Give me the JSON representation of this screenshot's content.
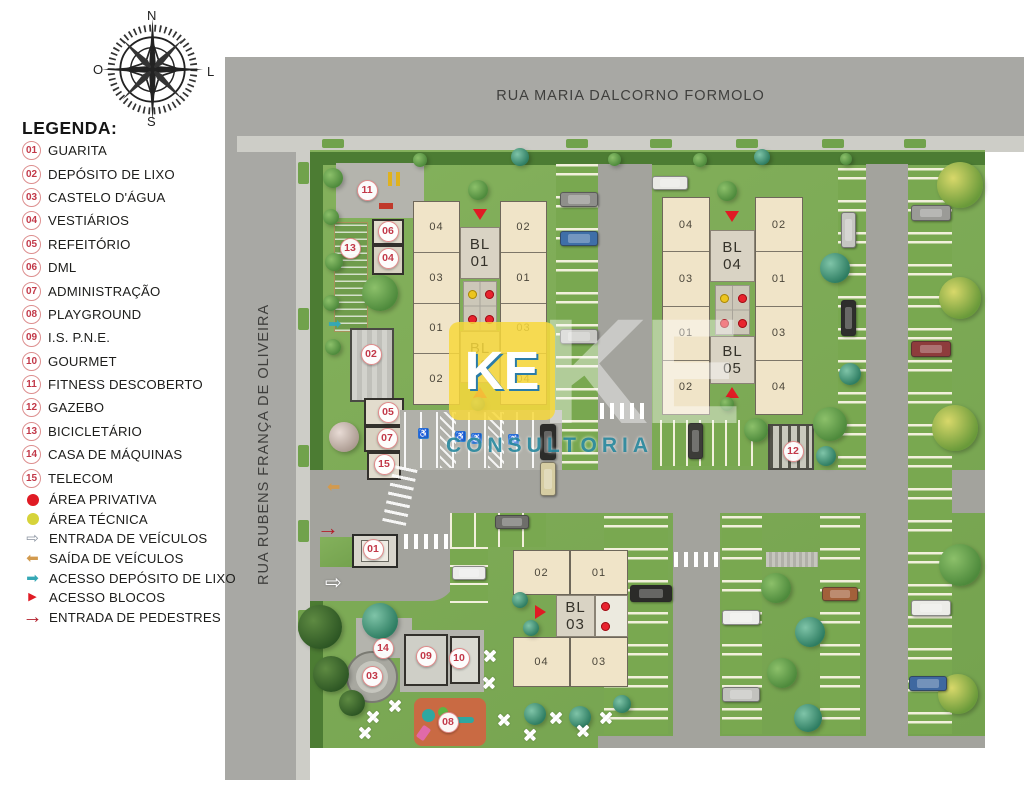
{
  "page": {
    "background": "#ffffff"
  },
  "compass": {
    "north": "N",
    "south": "S",
    "east": "L",
    "west": "O"
  },
  "streets": {
    "top": "RUA MARIA DALCORNO FORMOLO",
    "left": "RUA RUBENS FRANÇA DE OLIVEIRA"
  },
  "legend": {
    "title": "LEGENDA:",
    "numbered_items": [
      {
        "num": "01",
        "label": "GUARITA"
      },
      {
        "num": "02",
        "label": "DEPÓSITO DE LIXO"
      },
      {
        "num": "03",
        "label": "CASTELO D'ÁGUA"
      },
      {
        "num": "04",
        "label": "VESTIÁRIOS"
      },
      {
        "num": "05",
        "label": "REFEITÓRIO"
      },
      {
        "num": "06",
        "label": "DML"
      },
      {
        "num": "07",
        "label": "ADMINISTRAÇÃO"
      },
      {
        "num": "08",
        "label": "PLAYGROUND"
      },
      {
        "num": "09",
        "label": "I.S. P.N.E."
      },
      {
        "num": "10",
        "label": "GOURMET"
      },
      {
        "num": "11",
        "label": "FITNESS DESCOBERTO"
      },
      {
        "num": "12",
        "label": "GAZEBO"
      },
      {
        "num": "13",
        "label": "BICICLETÁRIO"
      },
      {
        "num": "14",
        "label": "CASA DE MÁQUINAS"
      },
      {
        "num": "15",
        "label": "TELECOM"
      }
    ],
    "symbol_items": [
      {
        "icon": "area-privativa-dot",
        "label": "ÁREA PRIVATIVA",
        "color": "#e01b24"
      },
      {
        "icon": "area-tecnica-dot",
        "label": "ÁREA TÉCNICA",
        "color": "#d6d33a"
      },
      {
        "icon": "entrada-veiculos-arrow",
        "label": "ENTRADA DE VEÍCULOS",
        "color": "#8a93a0"
      },
      {
        "icon": "saida-veiculos-arrow",
        "label": "SAÍDA DE VEÍCULOS",
        "color": "#d29a4e"
      },
      {
        "icon": "acesso-deposito-arrow",
        "label": "ACESSO DEPÓSITO DE LIXO",
        "color": "#35a8b5"
      },
      {
        "icon": "acesso-blocos-triangle",
        "label": "ACESSO BLOCOS",
        "color": "#e01b24"
      },
      {
        "icon": "entrada-pedestres-arrow",
        "label": "ENTRADA DE PEDESTRES",
        "color": "#b3202c"
      }
    ]
  },
  "buildings": {
    "bl01_02": {
      "top_label": [
        "BL",
        "01"
      ],
      "bottom_label": [
        "BL",
        "02"
      ],
      "left_units": [
        "04",
        "03",
        "01",
        "02"
      ],
      "right_units": [
        "02",
        "01",
        "03",
        "04"
      ]
    },
    "bl04_05": {
      "top_label": [
        "BL",
        "04"
      ],
      "bottom_label": [
        "BL",
        "05"
      ],
      "left_units": [
        "04",
        "03",
        "01",
        "02"
      ],
      "right_units": [
        "02",
        "01",
        "03",
        "04"
      ]
    },
    "bl03": {
      "label": [
        "BL",
        "03"
      ],
      "top_units": [
        "02",
        "01"
      ],
      "bottom_units": [
        "04",
        "03"
      ]
    }
  },
  "map_markers": [
    "01",
    "02",
    "03",
    "04",
    "05",
    "06",
    "07",
    "08",
    "09",
    "10",
    "11",
    "12",
    "13",
    "14",
    "15"
  ],
  "watermark": {
    "logo": "KE",
    "ghost": "KE",
    "subtitle": "CONSULTORIA"
  }
}
